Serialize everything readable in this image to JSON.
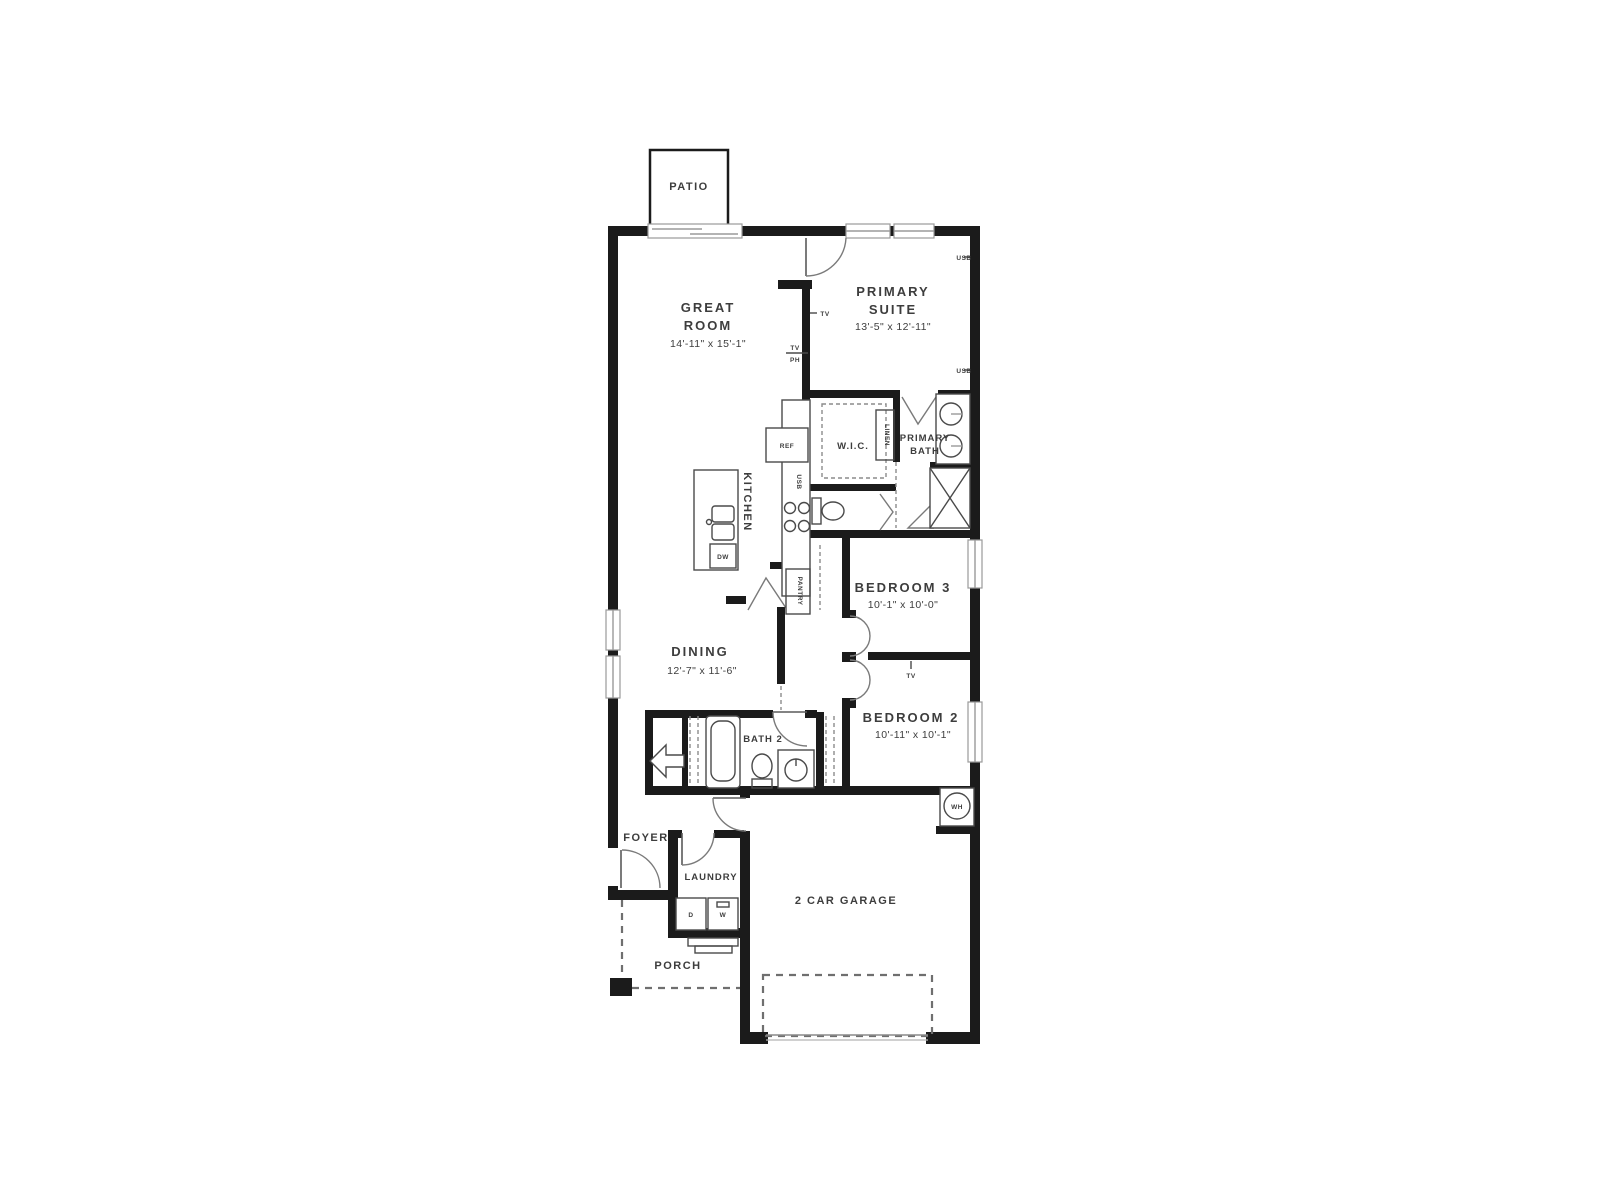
{
  "plan": {
    "type": "single-story residential floor plan",
    "colors": {
      "background": "#ffffff",
      "walls": "#1b1b1b",
      "text": "#3d3d3d",
      "door_arc": "#7a7a7a",
      "dashed": "#8c8c8c"
    },
    "rooms": {
      "patio": {
        "label": "PATIO"
      },
      "great_room": {
        "line1": "GREAT",
        "line2": "ROOM",
        "dims": "14'-11\" x 15'-1\""
      },
      "primary_suite": {
        "line1": "PRIMARY",
        "line2": "SUITE",
        "dims": "13'-5\" x 12'-11\""
      },
      "wic": {
        "label": "W.I.C."
      },
      "primary_bath": {
        "line1": "PRIMARY",
        "line2": "BATH"
      },
      "kitchen": {
        "label": "KITCHEN"
      },
      "pantry": {
        "label": "PANTRY"
      },
      "linen": {
        "label": "LINEN"
      },
      "dining": {
        "label": "DINING",
        "dims": "12'-7\" x 11'-6\""
      },
      "bedroom3": {
        "label": "BEDROOM 3",
        "dims": "10'-1\" x 10'-0\""
      },
      "bedroom2": {
        "label": "BEDROOM 2",
        "dims": "10'-11\" x 10'-1\""
      },
      "bath2": {
        "label": "BATH 2"
      },
      "foyer": {
        "label": "FOYER"
      },
      "laundry": {
        "label": "LAUNDRY"
      },
      "porch": {
        "label": "PORCH"
      },
      "garage": {
        "label": "2 CAR GARAGE"
      }
    },
    "tags": {
      "usb": "USB",
      "tv": "TV",
      "ph": "PH",
      "ref": "REF",
      "dw": "DW",
      "dryer": "D",
      "washer": "W",
      "water_heater": "WH"
    }
  }
}
